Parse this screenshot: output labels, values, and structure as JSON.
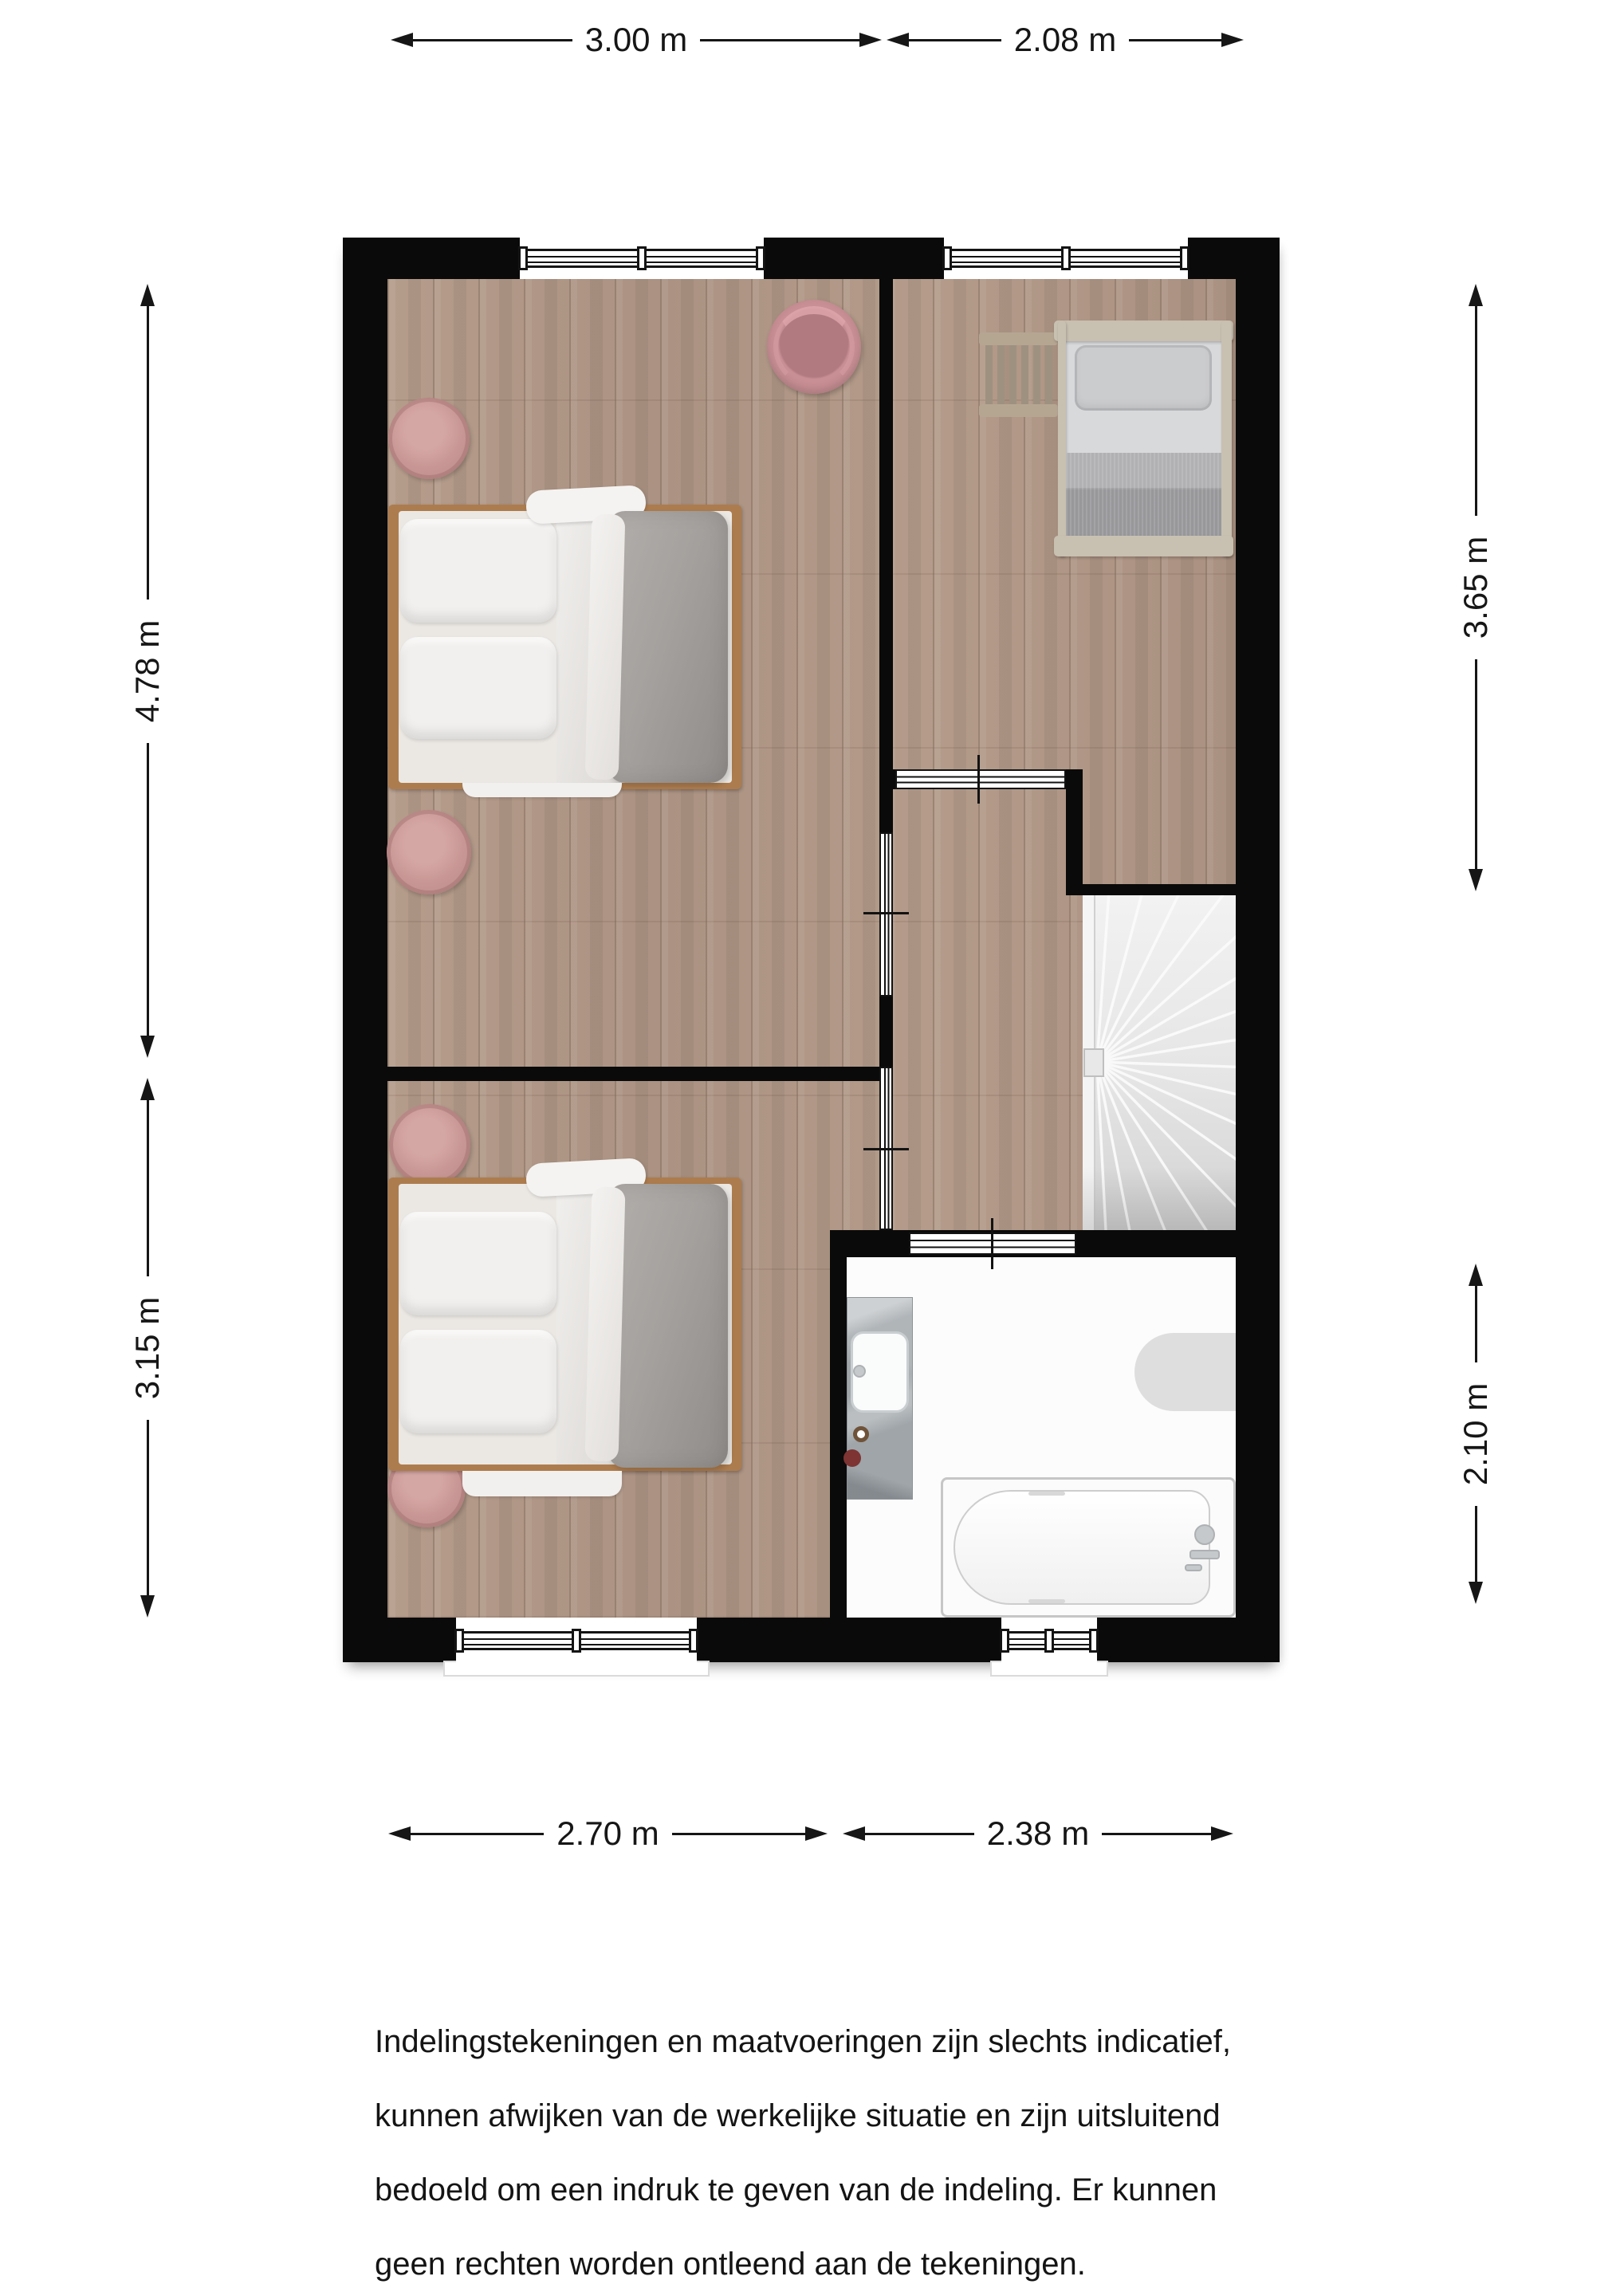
{
  "dimensions": {
    "top": [
      {
        "label": "3.00 m"
      },
      {
        "label": "2.08 m"
      }
    ],
    "bottom": [
      {
        "label": "2.70 m"
      },
      {
        "label": "2.38 m"
      }
    ],
    "left": [
      {
        "label": "4.78 m"
      },
      {
        "label": "3.15 m"
      }
    ],
    "right": [
      {
        "label": "3.65 m"
      },
      {
        "label": "2.10 m"
      }
    ]
  },
  "disclaimer": {
    "lines": [
      "Indelingstekeningen en maatvoeringen zijn slechts indicatief,",
      "kunnen afwijken van de werkelijke situatie en zijn uitsluitend",
      "bedoeld om een indruk te geven van de indeling. Er kunnen",
      "geen rechten worden ontleend aan de tekeningen."
    ]
  },
  "colors": {
    "wall": "#0a0a0a",
    "floor_wood": "#b19887",
    "bathroom_floor": "#fcfcfc",
    "accent_pink": "#c48b90",
    "bedding_gray": "#a19d9a",
    "bed_frame_wood": "#ad7c4e",
    "stair_gray": "#e3e3e3",
    "dimension_ink": "#161616"
  }
}
